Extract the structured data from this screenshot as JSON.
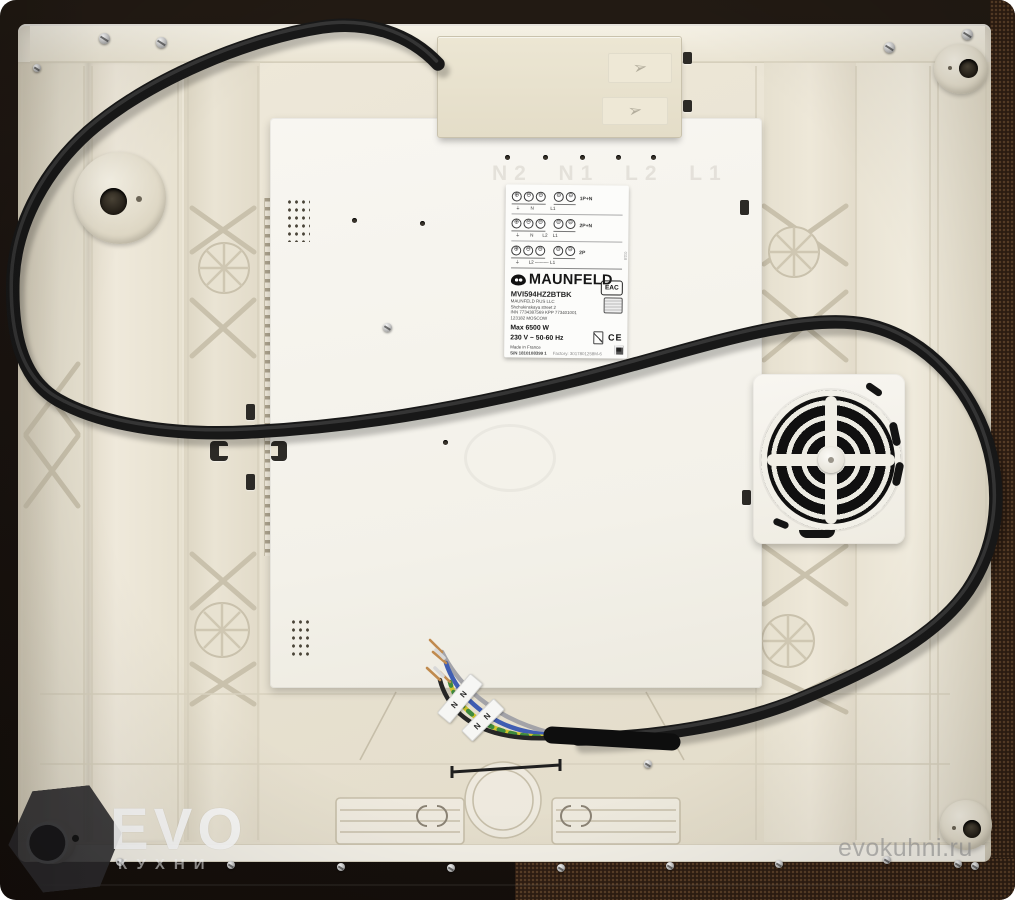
{
  "label": {
    "brand": "MAUNFELD",
    "model": "MVI594HZ2BTBK",
    "company": "MAUNFELD RUS LLC",
    "address1": "Shchukinskaya street 2",
    "address2": "INN 7734387569 KPP 773401001",
    "address3": "123182 MOSCOW",
    "power": "Max  6500 W",
    "voltage": "230 V ~ 50-60 Hz",
    "origin": "Made in France",
    "serial": "S/N 1810108399 1",
    "factory": "Factory: 3017801258M-6",
    "eac": "EAC",
    "ce": "CE",
    "side_code": "0118",
    "wiring_rows": [
      {
        "tag": "1P+N",
        "letters": "⏚        N             L1"
      },
      {
        "tag": "2P+N",
        "letters": "⏚        N       L2    L1"
      },
      {
        "tag": "2P",
        "letters": "⏚       L2 ——— L1"
      }
    ]
  },
  "plate": {
    "ghost_row": "N2  N1  L2  L1"
  },
  "wire_bands": {
    "band1": "N N",
    "band2": "N N"
  },
  "watermarks": {
    "evo_text": "EVO",
    "evo_sub": "КУХНИ",
    "site": "evokuhni.ru"
  },
  "colors": {
    "frame_dark": "#1b1410",
    "frame_brown": "#2d1d12",
    "base_cream": "#e9e3d3",
    "plate_white": "#f6f4ee",
    "terminal_box": "#e8e2cf",
    "cable_black": "#181818",
    "wire_blue": "#3f5db2",
    "wire_gray": "#a3a3a8",
    "earth_yellow": "#cfc42d",
    "earth_green": "#3e8a3e",
    "copper": "#c08a4e"
  }
}
